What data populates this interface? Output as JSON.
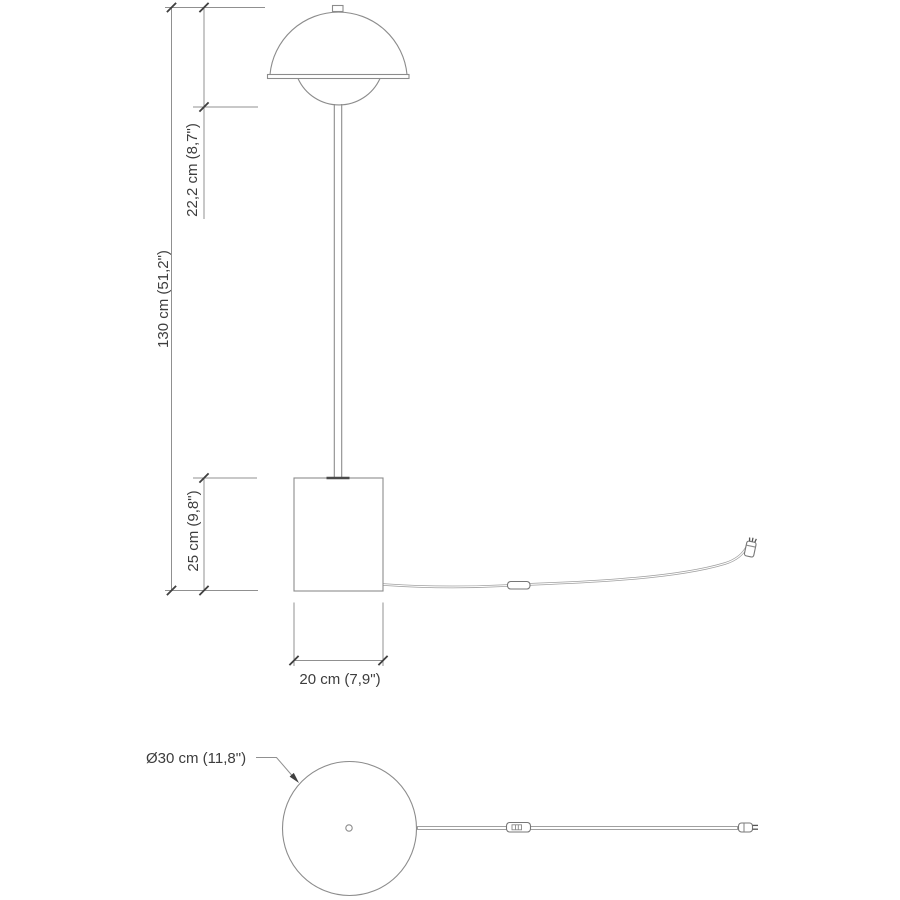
{
  "app": {
    "background": "#ffffff",
    "description_not_shown": ""
  },
  "palette": {
    "drawing_line": "#8c8c8c",
    "dimension_line": "#909090",
    "tick_and_arrow": "#3f3f3f",
    "text": "#3d3d3d",
    "cord": "#a0a0a0"
  },
  "front_view": {
    "shade_height_label": "22,2 cm (8,7\")",
    "total_height_label": "130 cm (51,2\")",
    "base_height_label": "25 cm (9,8\")",
    "base_width_label": "20 cm (7,9\")"
  },
  "top_view": {
    "base_diameter_label": "Ø30 cm (11,8\")"
  }
}
